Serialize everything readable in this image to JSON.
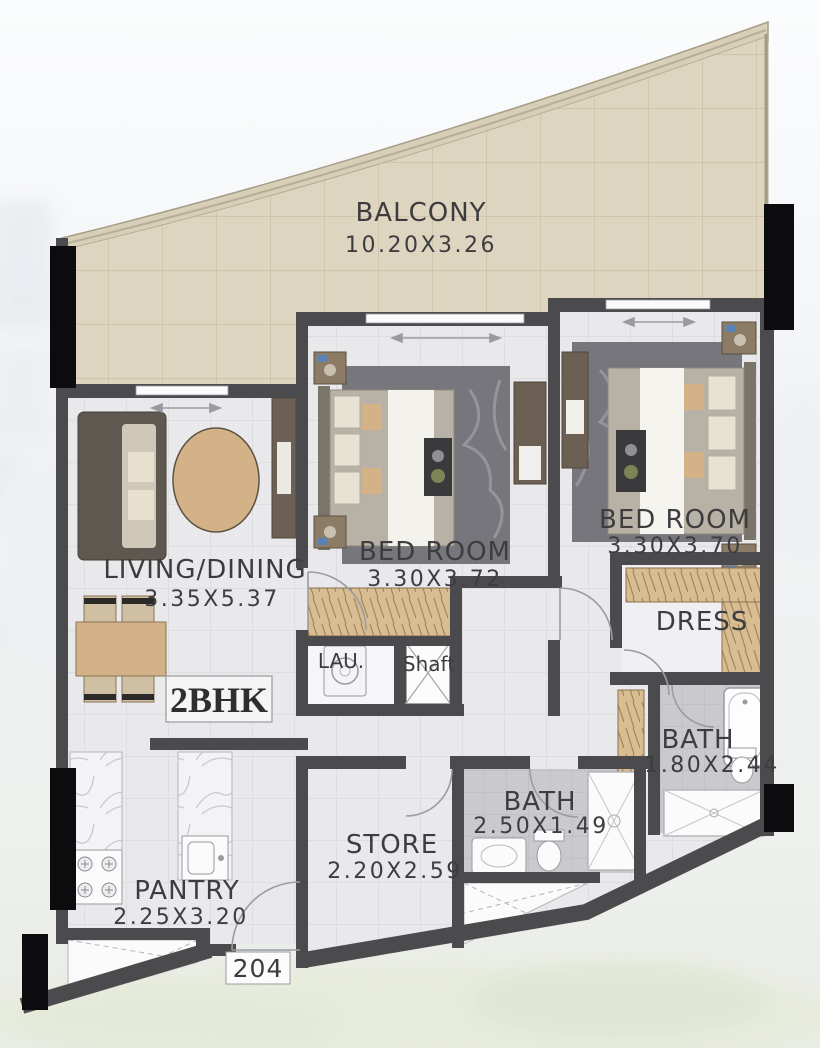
{
  "plan": {
    "unit_type_label": "2BHK",
    "unit_number": "204",
    "rooms": {
      "balcony": {
        "name": "BALCONY",
        "dims": "10.20X3.26"
      },
      "living_dining": {
        "name": "LIVING/DINING",
        "dims": "3.35X5.37"
      },
      "bedroom_middle": {
        "name": "BED ROOM",
        "dims": "3.30X3.72"
      },
      "bedroom_right": {
        "name": "BED ROOM",
        "dims": "3.30X3.70"
      },
      "dress": {
        "name": "DRESS"
      },
      "bath_ensuite": {
        "name": "BATH",
        "dims": "1.80X2.44"
      },
      "bath_common": {
        "name": "BATH",
        "dims": "2.50X1.49"
      },
      "store": {
        "name": "STORE",
        "dims": "2.20X2.59"
      },
      "pantry": {
        "name": "PANTRY",
        "dims": "2.25X3.20"
      },
      "laundry": {
        "name": "LAU."
      },
      "shaft": {
        "name": "Shaft"
      }
    },
    "colors": {
      "wall": "#4b4b4e",
      "window_bar": "#0c0c0e",
      "balcony_floor": "#ded5c0",
      "interior_floor": "#e9e9ec",
      "bath_floor": "#cacace",
      "wood_accent": "#d2b286",
      "dark_furniture": "#6b6053",
      "label_text": "#3d3d3f"
    }
  }
}
